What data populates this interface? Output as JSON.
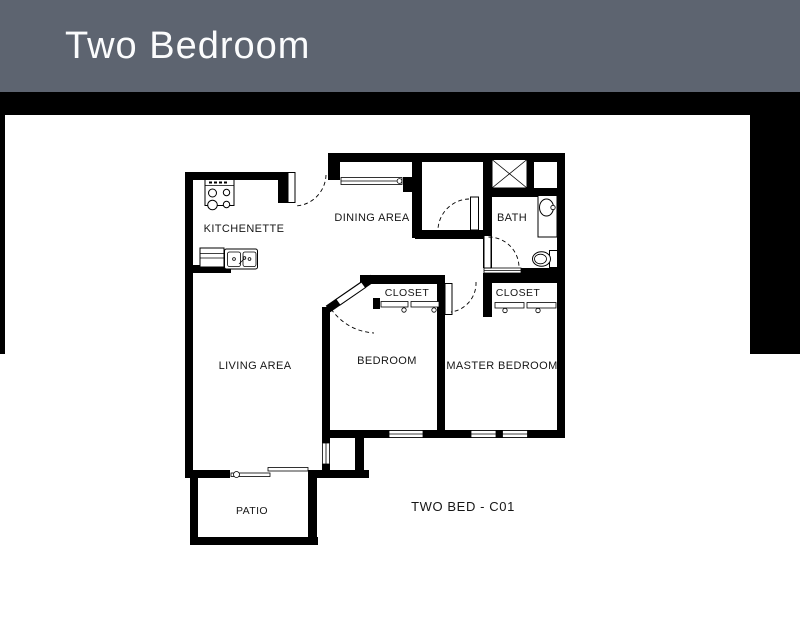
{
  "header": {
    "title": "Two Bedroom"
  },
  "colors": {
    "header_bg": "#5d6470",
    "header_text": "#fbfcfd",
    "band_bg": "#000000",
    "panel_bg": "#ffffff",
    "wall": "#000000",
    "label_text": "#161616"
  },
  "plan": {
    "unit_label": "TWO BED - C01",
    "rooms": {
      "kitchenette": "KITCHENETTE",
      "dining_area": "DINING AREA",
      "bath": "BATH",
      "bedroom_closet": "CLOSET",
      "master_closet": "CLOSET",
      "living_area": "LIVING AREA",
      "bedroom": "BEDROOM",
      "master_bedroom": "MASTER BEDROOM",
      "patio": "PATIO"
    },
    "fixtures": [
      "stove-icon",
      "kitchen-sink-icon",
      "shower-icon",
      "bathroom-sink-icon",
      "toilet-icon"
    ]
  }
}
